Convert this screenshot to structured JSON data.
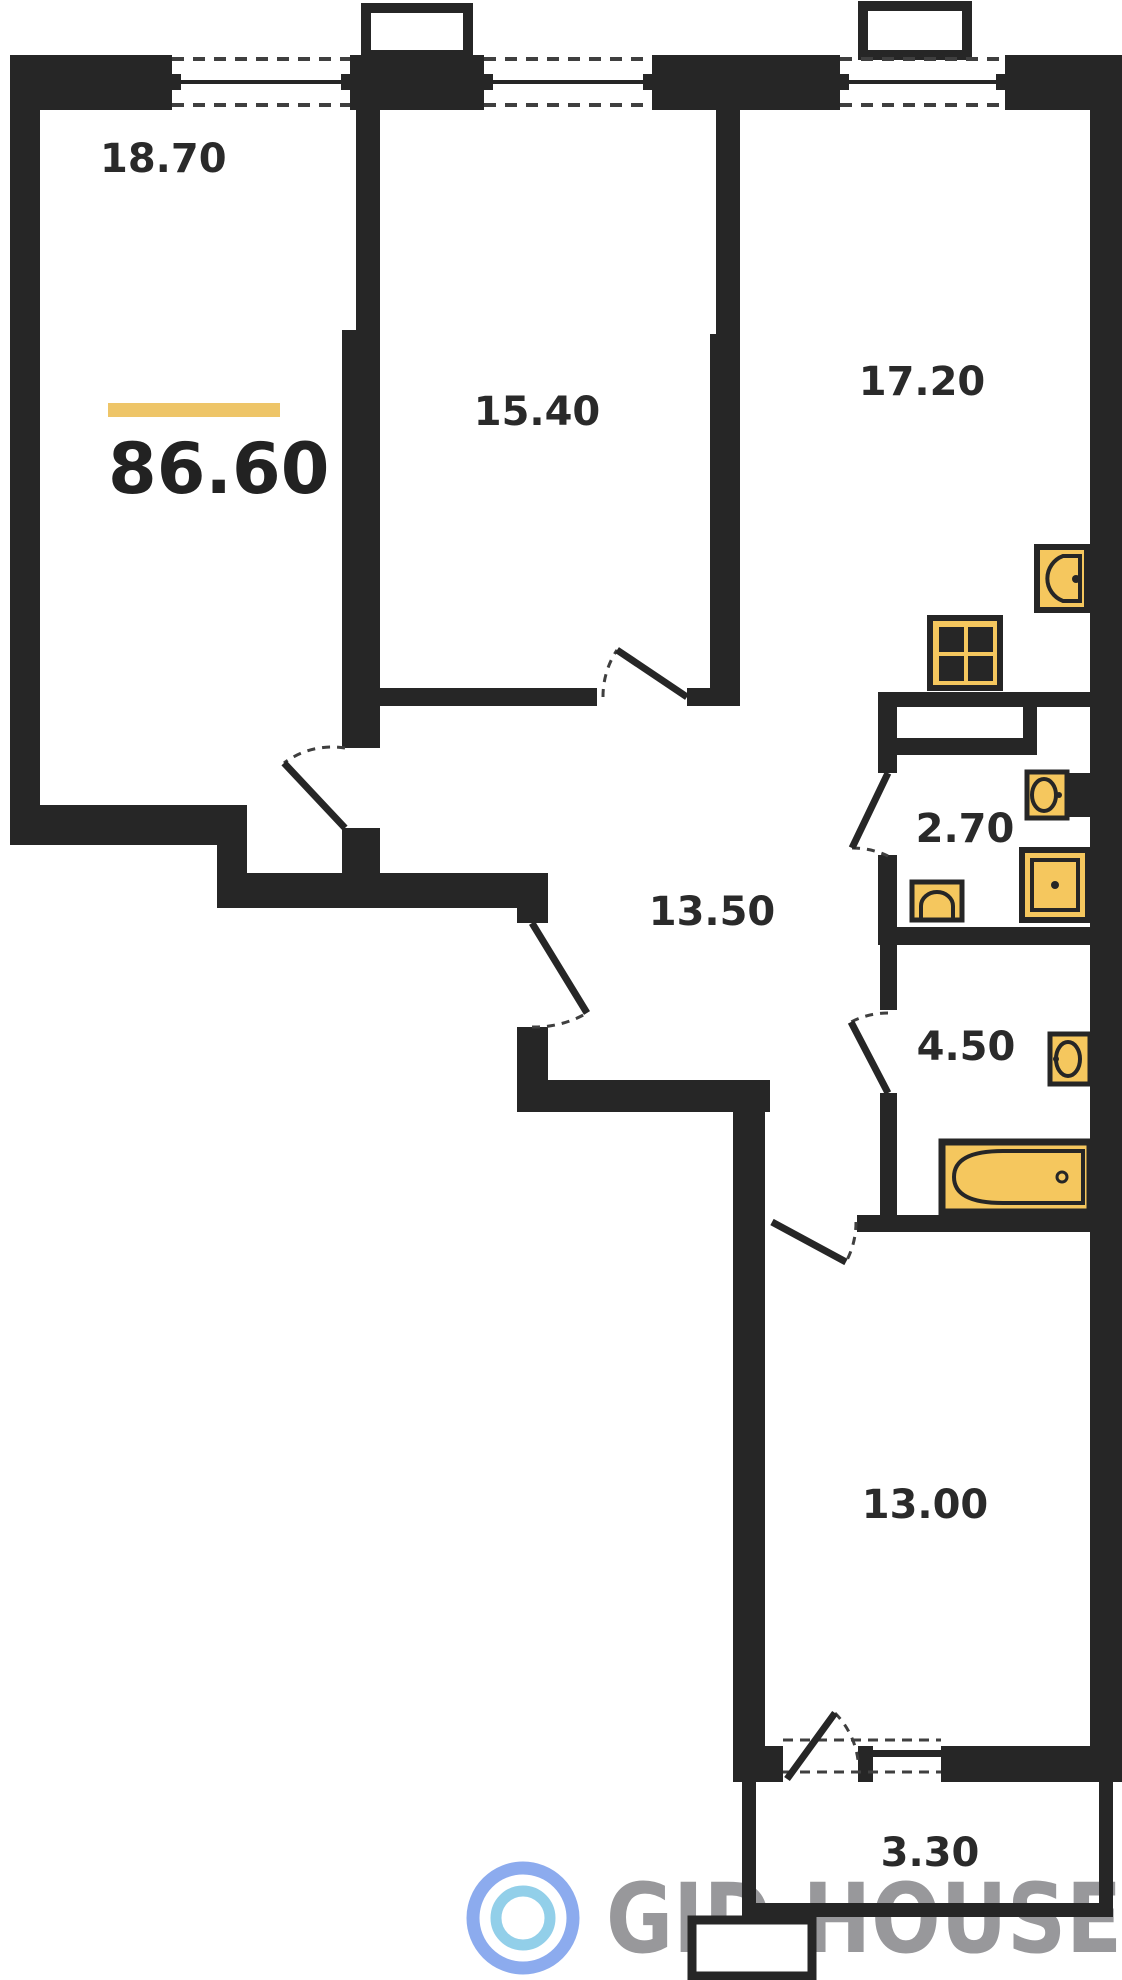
{
  "plan": {
    "type": "apartment-floor-plan",
    "total_area_label": "86.60",
    "rooms": [
      {
        "name": "living-room",
        "area_label": "18.70"
      },
      {
        "name": "bedroom",
        "area_label": "15.40"
      },
      {
        "name": "kitchen-living",
        "area_label": "17.20"
      },
      {
        "name": "hallway",
        "area_label": "13.50"
      },
      {
        "name": "wc",
        "area_label": "2.70"
      },
      {
        "name": "bathroom",
        "area_label": "4.50"
      },
      {
        "name": "bedroom-2",
        "area_label": "13.00"
      },
      {
        "name": "balcony",
        "area_label": "3.30"
      }
    ],
    "fixtures": [
      "kitchen-sink",
      "stove-4-burner",
      "wc-sink",
      "washing-machine",
      "toilet",
      "bathroom-sink",
      "bathtub"
    ],
    "windows_count": 4,
    "doors_count": 7,
    "colors": {
      "wall": "#262626",
      "fixture_fill": "#f5c75e",
      "accent_bar": "#eec568",
      "watermark_text": "#98989b",
      "logo_outer_ring": "#8cabee",
      "logo_inner_ring": "#92cfe9"
    }
  },
  "watermark": {
    "text": "GID.HOUSE"
  }
}
